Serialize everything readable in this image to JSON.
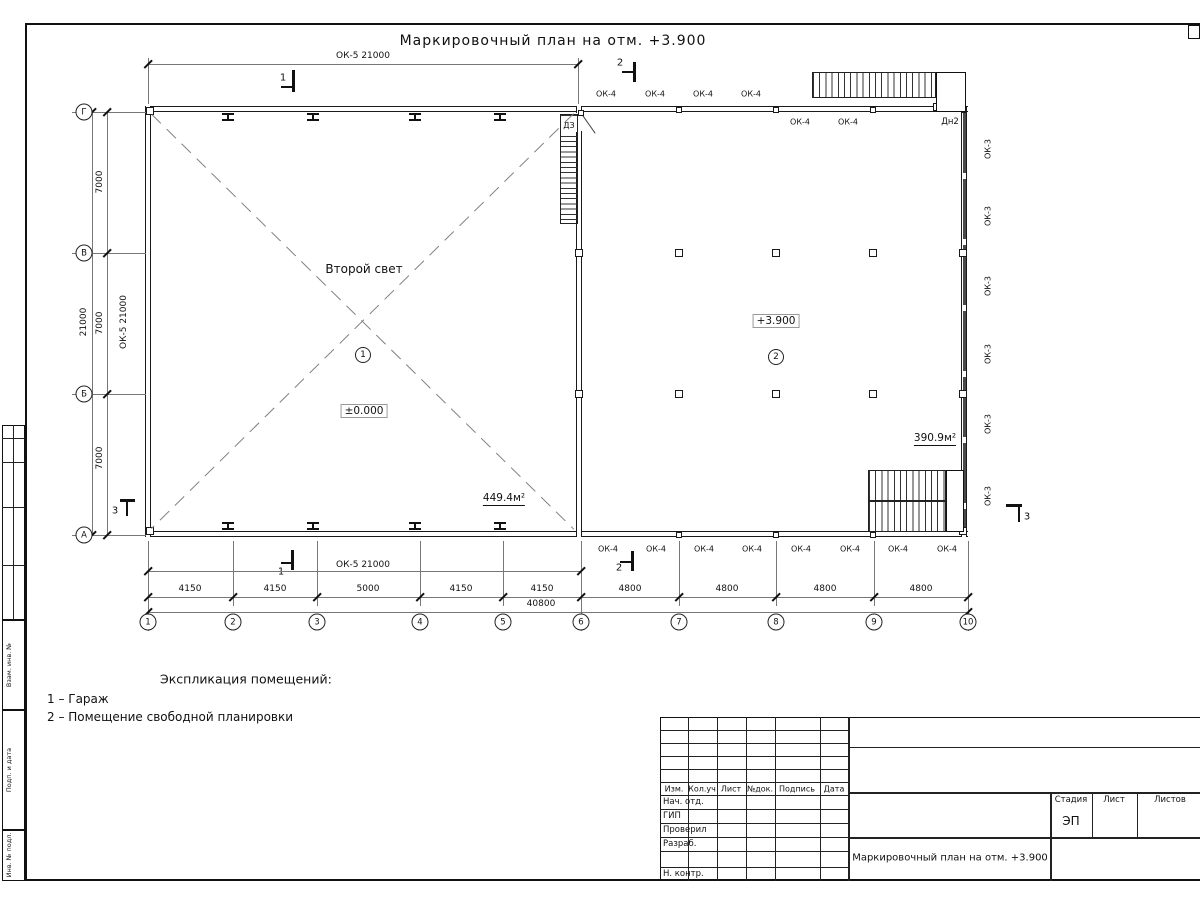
{
  "sheet": {
    "title": "Маркировочный план на отм. +3.900"
  },
  "plan": {
    "rooms": {
      "room1": {
        "number": "1",
        "note": "Второй свет",
        "level": "±0.000",
        "area": "449.4м²"
      },
      "room2": {
        "number": "2",
        "level": "+3.900",
        "area": "390.9м²"
      }
    },
    "marks": {
      "ok4": "ОК-4",
      "ok3": "ОК-3",
      "ok5": "ОК-5 21000",
      "dn2": "Дн2",
      "dz": "ДЗ"
    },
    "sections": {
      "s1": "1",
      "s2": "2",
      "s3": "3"
    },
    "dims": {
      "top_ok5": "ОК-5 21000",
      "bottom_ok5": "ОК-5 21000",
      "left_ok5": "ОК-5 21000",
      "left_spans": [
        "7000",
        "7000",
        "7000"
      ],
      "left_total": "21000",
      "bottom_spans": [
        "4150",
        "4150",
        "5000",
        "4150",
        "4150",
        "4800",
        "4800",
        "4800",
        "4800"
      ],
      "bottom_total": "40800"
    },
    "axes": {
      "rows": [
        "Г",
        "В",
        "Б",
        "А"
      ],
      "cols": [
        "1",
        "2",
        "3",
        "4",
        "5",
        "6",
        "7",
        "8",
        "9",
        "10"
      ]
    }
  },
  "schedule": {
    "heading": "Экспликация помещений:",
    "items": [
      "1 – Гараж",
      "2 – Помещение свободной планировки"
    ]
  },
  "titleblock": {
    "columns": [
      "Изм.",
      "Кол.уч",
      "Лист",
      "№док.",
      "Подпись",
      "Дата"
    ],
    "rows": [
      "Нач. отд.",
      "ГИП",
      "Проверил",
      "Разраб.",
      "Н. контр."
    ],
    "stage_label": "Стадия",
    "sheet_label": "Лист",
    "sheets_label": "Листов",
    "stage": "ЭП",
    "doc_title": "Маркировочный план на отм. +3.900"
  },
  "frame_labels": [
    "Взам. инв. №",
    "Подп. и дата",
    "Инв. № подл."
  ]
}
